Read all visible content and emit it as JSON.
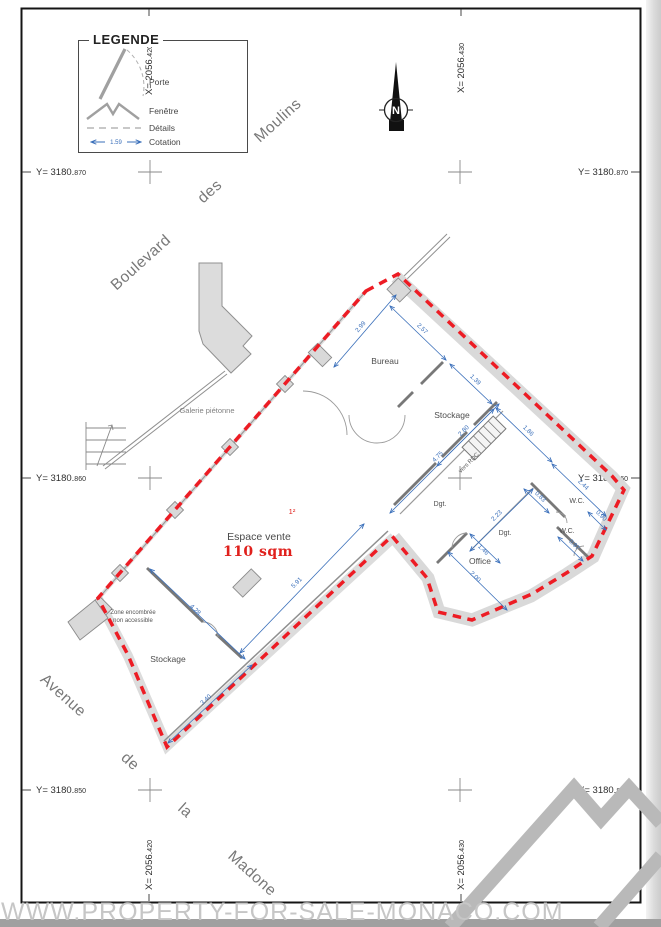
{
  "page": {
    "watermark": "WWW.PROPERTY-FOR-SALE-MONACO.COM"
  },
  "legend": {
    "title": "LEGENDE",
    "items": [
      {
        "symbol": "door",
        "label": "Porte"
      },
      {
        "symbol": "window",
        "label": "Fenêtre"
      },
      {
        "symbol": "details",
        "label": "Détails"
      },
      {
        "symbol": "dimension",
        "label": "Cotation"
      }
    ],
    "sample_dim": "1.59"
  },
  "compass": {
    "letter": "N"
  },
  "grid": {
    "x": [
      {
        "main": "X= 2056.",
        "small": "420"
      },
      {
        "main": "X= 2056.",
        "small": "430"
      }
    ],
    "y": [
      {
        "main": "Y= 3180.",
        "small": "870"
      },
      {
        "main": "Y= 3180.",
        "small": "860"
      },
      {
        "main": "Y= 3180.",
        "small": "850"
      }
    ]
  },
  "streets": {
    "boulevard": [
      "Boulevard",
      "des",
      "Moulins"
    ],
    "avenue": [
      "Avenue",
      "de",
      "la",
      "Madone"
    ],
    "galerie": "Galerie piétonne"
  },
  "plan": {
    "rooms": [
      {
        "name": "Bureau"
      },
      {
        "name": "Stockage"
      },
      {
        "name": "Dgt."
      },
      {
        "name": "Dgt."
      },
      {
        "name": "W.C."
      },
      {
        "name": "W.C."
      },
      {
        "name": "Office"
      },
      {
        "name": "Stockage"
      }
    ],
    "sales_area": {
      "label": "Espace vente",
      "area": "110 sqm",
      "marker": "1²"
    },
    "notes": {
      "zone_line1": "Zone encombrée",
      "zone_line2": "non accessible",
      "stairs": "vers RDC"
    },
    "dims": [
      {
        "v": "2.99"
      },
      {
        "v": "2.57"
      },
      {
        "v": "1.39"
      },
      {
        "v": "1.86"
      },
      {
        "v": "2.44"
      },
      {
        "v": "0.83"
      },
      {
        "v": "0.90"
      },
      {
        "v": "0.97"
      },
      {
        "v": "2.23"
      },
      {
        "v": "1.46"
      },
      {
        "v": "2.00"
      },
      {
        "v": "2.80"
      },
      {
        "v": "4.75"
      },
      {
        "v": "4.28"
      },
      {
        "v": "3.40"
      },
      {
        "v": "5.91"
      }
    ],
    "colors": {
      "boundary": "#ed1c24",
      "dimension": "#3a6fba",
      "area_text": "#e0201c",
      "wall_fill": "#d9d9d9"
    }
  }
}
